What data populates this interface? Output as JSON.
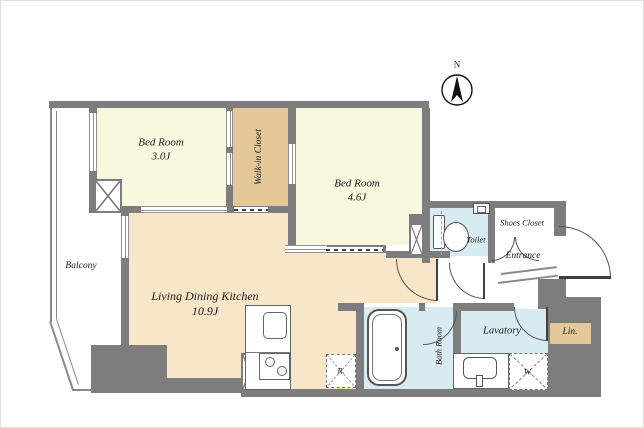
{
  "compass": {
    "label": "N"
  },
  "rooms": {
    "bedroom1": {
      "name": "Bed Room",
      "area": "3.0J"
    },
    "bedroom2": {
      "name": "Bed Room",
      "area": "4.6J"
    },
    "walk_in_closet": {
      "name": "Walk-in Closet"
    },
    "ldk": {
      "name": "Living Dining Kitchen",
      "area": "10.9J"
    },
    "balcony": {
      "name": "Balcony"
    },
    "toilet": {
      "name": "Toilet"
    },
    "shoes_closet": {
      "name": "Shoes Closet"
    },
    "entrance": {
      "name": "Entrance"
    },
    "bath": {
      "name": "Bath Room"
    },
    "lavatory": {
      "name": "Lavatory"
    },
    "linen": {
      "name": "Lin."
    },
    "washer": {
      "name": "W."
    },
    "refrigerator": {
      "name": "R."
    }
  },
  "colors": {
    "wall": "#7d7d7d",
    "bedroom_fill": "#faf7df",
    "closet_fill": "#e4c898",
    "ldk_fill": "#f7e6c8",
    "wet_fill": "#d9ebf2",
    "line": "#555555"
  }
}
